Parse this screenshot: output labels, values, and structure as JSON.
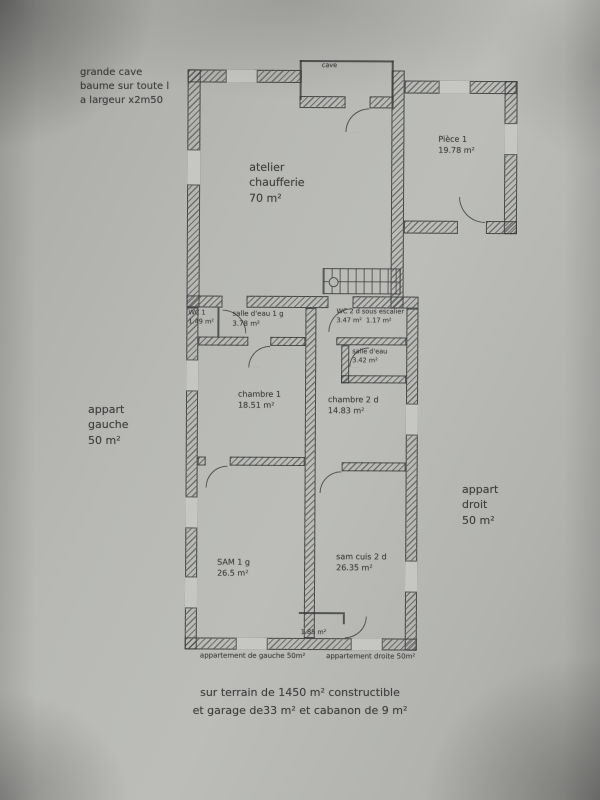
{
  "notes": {
    "top_left": [
      "grande cave",
      "baume sur toute l",
      "a largeur x2m50"
    ],
    "cave_label": "cave",
    "appart_gauche": [
      "appart",
      "gauche",
      "50 m²"
    ],
    "appart_droit": [
      "appart",
      "droit",
      "50 m²"
    ],
    "caption_left": "appartement de gauche 50m²",
    "caption_right": "appartement droite 50m²",
    "footer": [
      "sur terrain de 1450 m² constructible",
      "et garage de33 m² et cabanon de 9 m²"
    ]
  },
  "rooms": {
    "atelier": {
      "lines": [
        "atelier",
        "chaufferie",
        "70 m²"
      ]
    },
    "piece1": {
      "name": "Pièce 1",
      "area": "19.78 m²"
    },
    "wc1": {
      "name": "WC 1",
      "area": "1.49 m²"
    },
    "salle_eau_1": {
      "name": "salle d'eau 1 g",
      "area": "3.78 m²"
    },
    "wc2": {
      "name": "WC 2 d sous escalier",
      "area": "3.47 m²",
      "area2": "1.17 m²"
    },
    "salle_eau_2": {
      "name": "salle d'eau",
      "area": "3.42 m²"
    },
    "chambre1": {
      "name": "chambre 1",
      "area": "18.51 m²"
    },
    "chambre2": {
      "name": "chambre 2 d",
      "area": "14.83 m²"
    },
    "sam1": {
      "name": "SAM 1 g",
      "area": "26.5 m²"
    },
    "sam_cuis_2": {
      "name": "sam cuis 2 d",
      "area": "26.35 m²"
    },
    "wc_bas": {
      "area": "1.85 m²"
    }
  },
  "colors": {
    "ink": "#3c3d3d",
    "paper": "#b5b6b2"
  }
}
